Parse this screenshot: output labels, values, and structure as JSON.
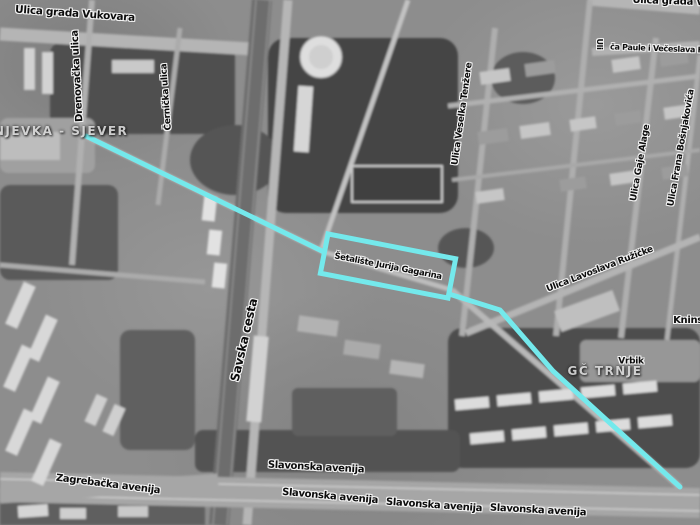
{
  "map": {
    "route": {
      "color": "#74E9EC",
      "segment_before_highlight": [
        [
          86,
          136
        ],
        [
          324,
          252
        ]
      ],
      "segment_after_highlight": [
        [
          449,
          294
        ],
        [
          500,
          310
        ],
        [
          553,
          371
        ],
        [
          680,
          487
        ]
      ],
      "highlight_box": {
        "cx": 388,
        "cy": 266,
        "width": 130,
        "height": 40,
        "rotation": 11
      },
      "highlight_label": "Šetalište Jurija Gagarina"
    },
    "district_labels": [
      {
        "text": "ŠNJEVKA - SJEVER",
        "x": 56,
        "y": 131,
        "r": 0,
        "size": 12
      },
      {
        "text": "GČ TRNJE",
        "x": 605,
        "y": 371,
        "r": 0,
        "size": 12
      }
    ],
    "street_labels": [
      {
        "text": "Ulica grada Vukovara",
        "x": 75,
        "y": 14,
        "r": 4,
        "size": 10.5
      },
      {
        "text": "Ulica grada V",
        "x": 668,
        "y": 2,
        "r": 2,
        "size": 10
      },
      {
        "text": "Uli",
        "x": 599,
        "y": 44,
        "r": 90,
        "size": 8
      },
      {
        "text": "ča Paule i Večeslava H",
        "x": 657,
        "y": 49,
        "r": 2,
        "size": 8
      },
      {
        "text": "Drenovačka ulica",
        "x": 78,
        "y": 76,
        "r": -93,
        "size": 10
      },
      {
        "text": "Černička ulica",
        "x": 167,
        "y": 97,
        "r": -94,
        "size": 9
      },
      {
        "text": "Ulica Veselka Tenžere",
        "x": 463,
        "y": 114,
        "r": -82,
        "size": 9
      },
      {
        "text": "Ulica Gaje Alage",
        "x": 641,
        "y": 163,
        "r": -80,
        "size": 9
      },
      {
        "text": "Ulica Frana Bošnjakovića",
        "x": 682,
        "y": 148,
        "r": -80,
        "size": 9
      },
      {
        "text": "Savska cesta",
        "x": 244,
        "y": 340,
        "r": -77,
        "size": 12
      },
      {
        "text": "Ulica Lavoslava Ružičke",
        "x": 600,
        "y": 270,
        "r": -21,
        "size": 9
      },
      {
        "text": "Knins",
        "x": 688,
        "y": 321,
        "r": 0,
        "size": 10
      },
      {
        "text": "Vrbik",
        "x": 631,
        "y": 362,
        "r": 0,
        "size": 9
      },
      {
        "text": "Zagrebačka avenija",
        "x": 108,
        "y": 485,
        "r": 7,
        "size": 10
      },
      {
        "text": "Slavonska avenija",
        "x": 316,
        "y": 468,
        "r": 3,
        "size": 10
      },
      {
        "text": "Slavonska avenija",
        "x": 330,
        "y": 497,
        "r": 5,
        "size": 10
      },
      {
        "text": "Slavonska avenija",
        "x": 434,
        "y": 506,
        "r": 4,
        "size": 10
      },
      {
        "text": "Slavonska avenija",
        "x": 538,
        "y": 511,
        "r": 3,
        "size": 10
      }
    ]
  }
}
